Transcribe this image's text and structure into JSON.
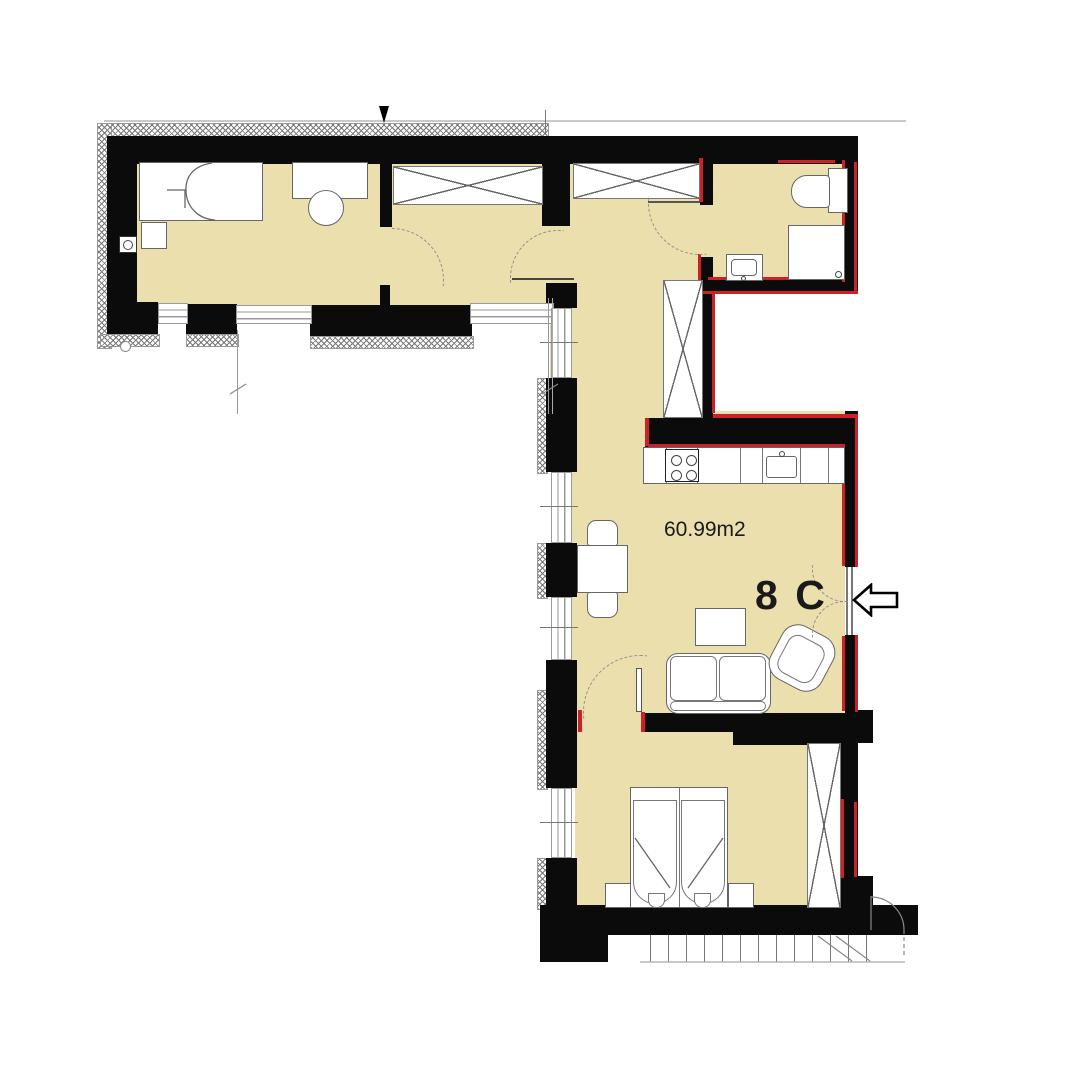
{
  "labels": {
    "area": "60.99m2",
    "unit": "8 C"
  },
  "colors": {
    "floor": "#ecdfae",
    "wall": "#0b0b0b",
    "accent_red": "#ce2127",
    "line_gray": "#8a8a8a",
    "top_boundary_gray": "#c9c9c9"
  },
  "icons": {
    "entrance_arrow": "left-block-arrow"
  },
  "furniture_symbols": [
    "single-bed",
    "nightstand",
    "desk",
    "stool",
    "wardrobe",
    "toilet",
    "shower",
    "washbasin",
    "kitchen-counter",
    "stove",
    "kitchen-sink",
    "dining-table",
    "dining-chair",
    "coffee-table",
    "sofa",
    "armchair",
    "double-bed"
  ]
}
